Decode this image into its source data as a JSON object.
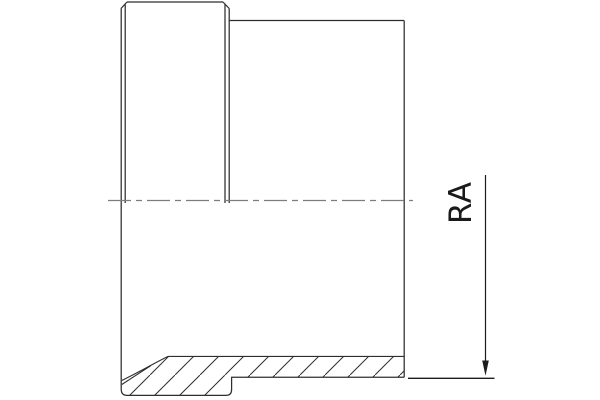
{
  "figure": {
    "annotation": {
      "label": "RA"
    },
    "colors": {
      "background": "#ffffff",
      "outline": "#2e2e2e",
      "centerline": "#7d7d7d",
      "hatch": "#2e2e2e",
      "dimension": "#1c1c1c",
      "label": "#1a1a1a"
    }
  }
}
